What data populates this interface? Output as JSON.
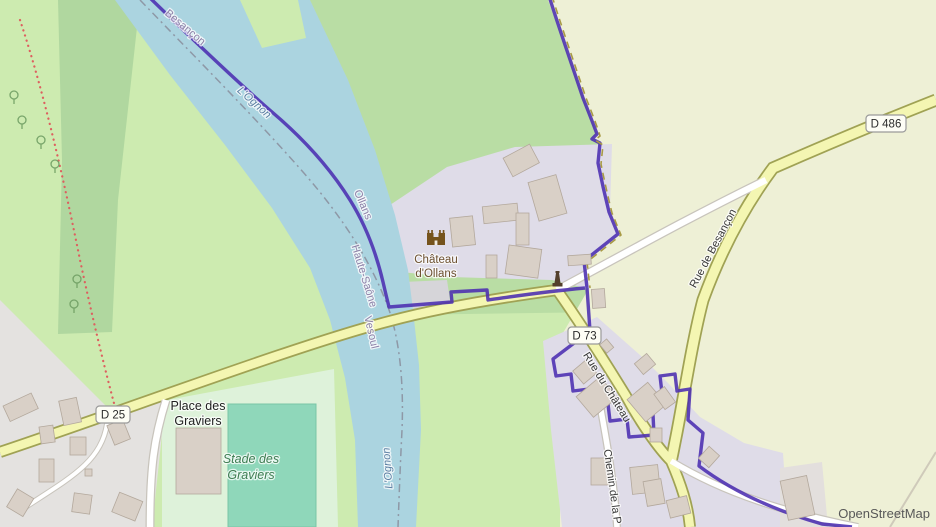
{
  "map": {
    "attribution": "OpenStreetMap",
    "labels": {
      "besancon_top": "Besançon",
      "river_name_upper": "L'Ognon",
      "river_name_lower": "L'Ognon",
      "commune_ollans": "Ollans",
      "department_haute_saone": "Haute-Saône",
      "arrondissement_vesoul": "Vesoul",
      "chateau_line1": "Château",
      "chateau_line2": "d'Ollans",
      "place_graviers_line1": "Place des",
      "place_graviers_line2": "Graviers",
      "stade_graviers_line1": "Stade des",
      "stade_graviers_line2": "Graviers",
      "rue_de_besancon": "Rue de Besançon",
      "rue_du_chateau": "Rue du Château",
      "chemin_de_la": "Chemin de la P",
      "shield_d25": "D 25",
      "shield_d73": "D 73",
      "shield_d486": "D 486"
    },
    "icons": [
      "castle-icon",
      "memorial-icon",
      "tree-icon"
    ],
    "colors": {
      "meadow": "#cdebb0",
      "forest": "#b9dda4",
      "farmland": "#eef0d6",
      "water": "#abd4e0",
      "residential": "#dfdce8",
      "residential_gray": "#e4e2e0",
      "building": "#d9d0c7",
      "road_secondary_fill": "#f4f6b2",
      "road_secondary_casing": "#a0a254",
      "road_white_fill": "#ffffff",
      "boundary_purple": "#4b2db0",
      "pitch_green": "#8fd7ba",
      "path_red": "#dd5f5f",
      "river_dash_gray": "#8e98a6",
      "track_olive": "#a89a45"
    }
  }
}
